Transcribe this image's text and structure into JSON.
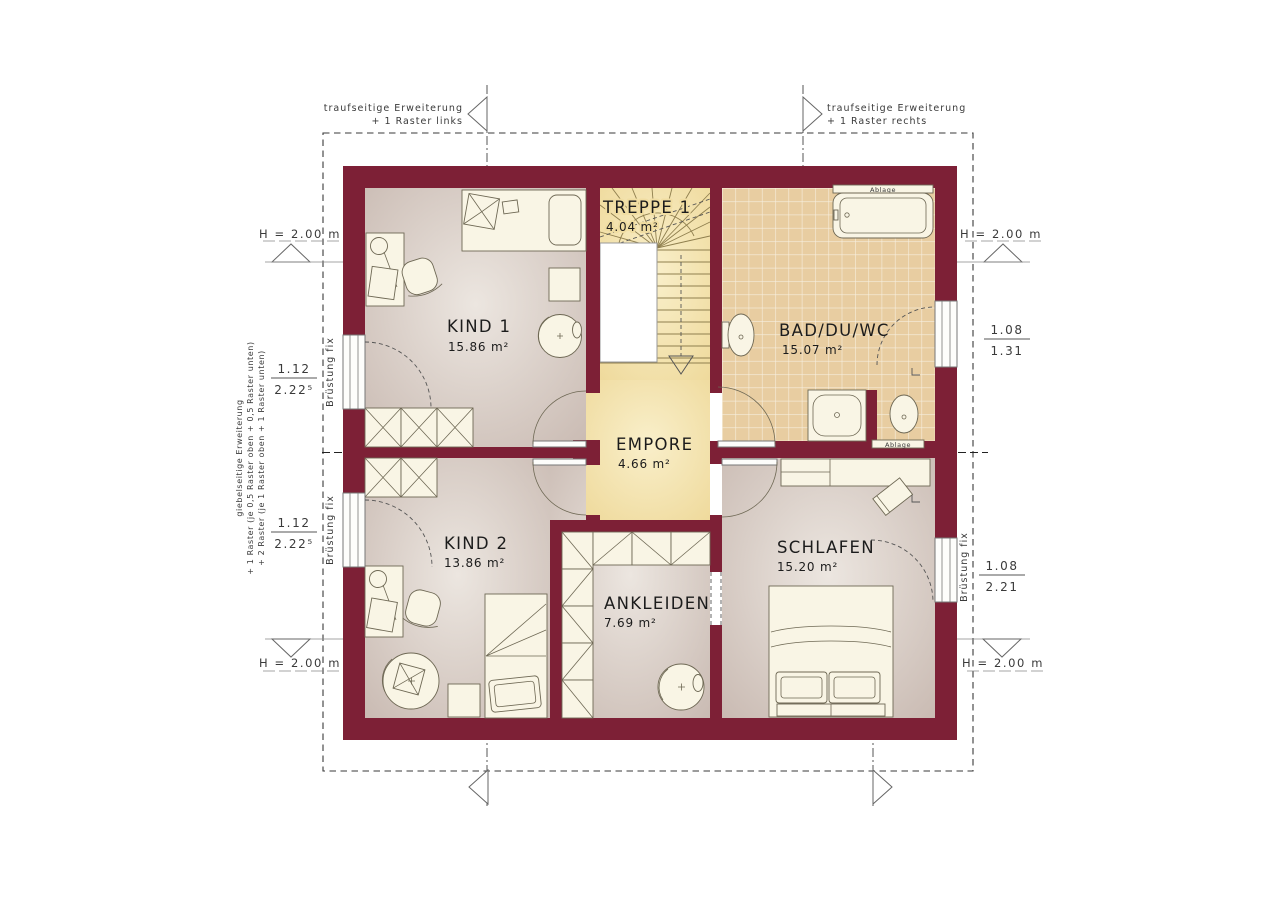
{
  "plan_title": "Obergeschoss Grundriss",
  "colors": {
    "wall": "#7d2036",
    "floor_edge": "#c9bab2",
    "floor_center": "#ece6e0",
    "stair_yellow": "#f1dd9e",
    "stair_yellow_light": "#f9efca",
    "tile": "#e8cda1",
    "furniture": "#f9f5e5",
    "annotation": "#3a3a3a"
  },
  "rooms": {
    "kind1": {
      "name": "KIND 1",
      "area": "15.86 m²"
    },
    "treppe1": {
      "name": "TREPPE 1",
      "area": "4.04 m²"
    },
    "bad": {
      "name": "BAD/DU/WC",
      "area": "15.07 m²"
    },
    "empore": {
      "name": "EMPORE",
      "area": "4.66 m²"
    },
    "kind2": {
      "name": "KIND 2",
      "area": "13.86 m²"
    },
    "ankleiden": {
      "name": "ANKLEIDEN",
      "area": "7.69 m²"
    },
    "schlafen": {
      "name": "SCHLAFEN",
      "area": "15.20 m²"
    }
  },
  "annotations": {
    "eave_left_1": "traufseitige Erweiterung",
    "eave_left_2": "+ 1 Raster links",
    "eave_right_1": "traufseitige Erweiterung",
    "eave_right_2": "+ 1 Raster rechts",
    "gable_1": "giebelseitige Erweiterung",
    "gable_2": "+ 1 Raster (je 0,5 Raster oben + 0,5 Raster unten)",
    "gable_3": "+ 2 Raster (je 1 Raster oben + 1 Raster unten)",
    "height": "H = 2.00 m",
    "parapet": "Brüstung fix",
    "shelf": "Ablage"
  },
  "dimensions": {
    "left_top_num": "1.12",
    "left_top_den": "2.22⁵",
    "left_bottom_num": "1.12",
    "left_bottom_den": "2.22⁵",
    "right_top_num": "1.08",
    "right_top_den": "1.31",
    "right_bottom_num": "1.08",
    "right_bottom_den": "2.21"
  }
}
